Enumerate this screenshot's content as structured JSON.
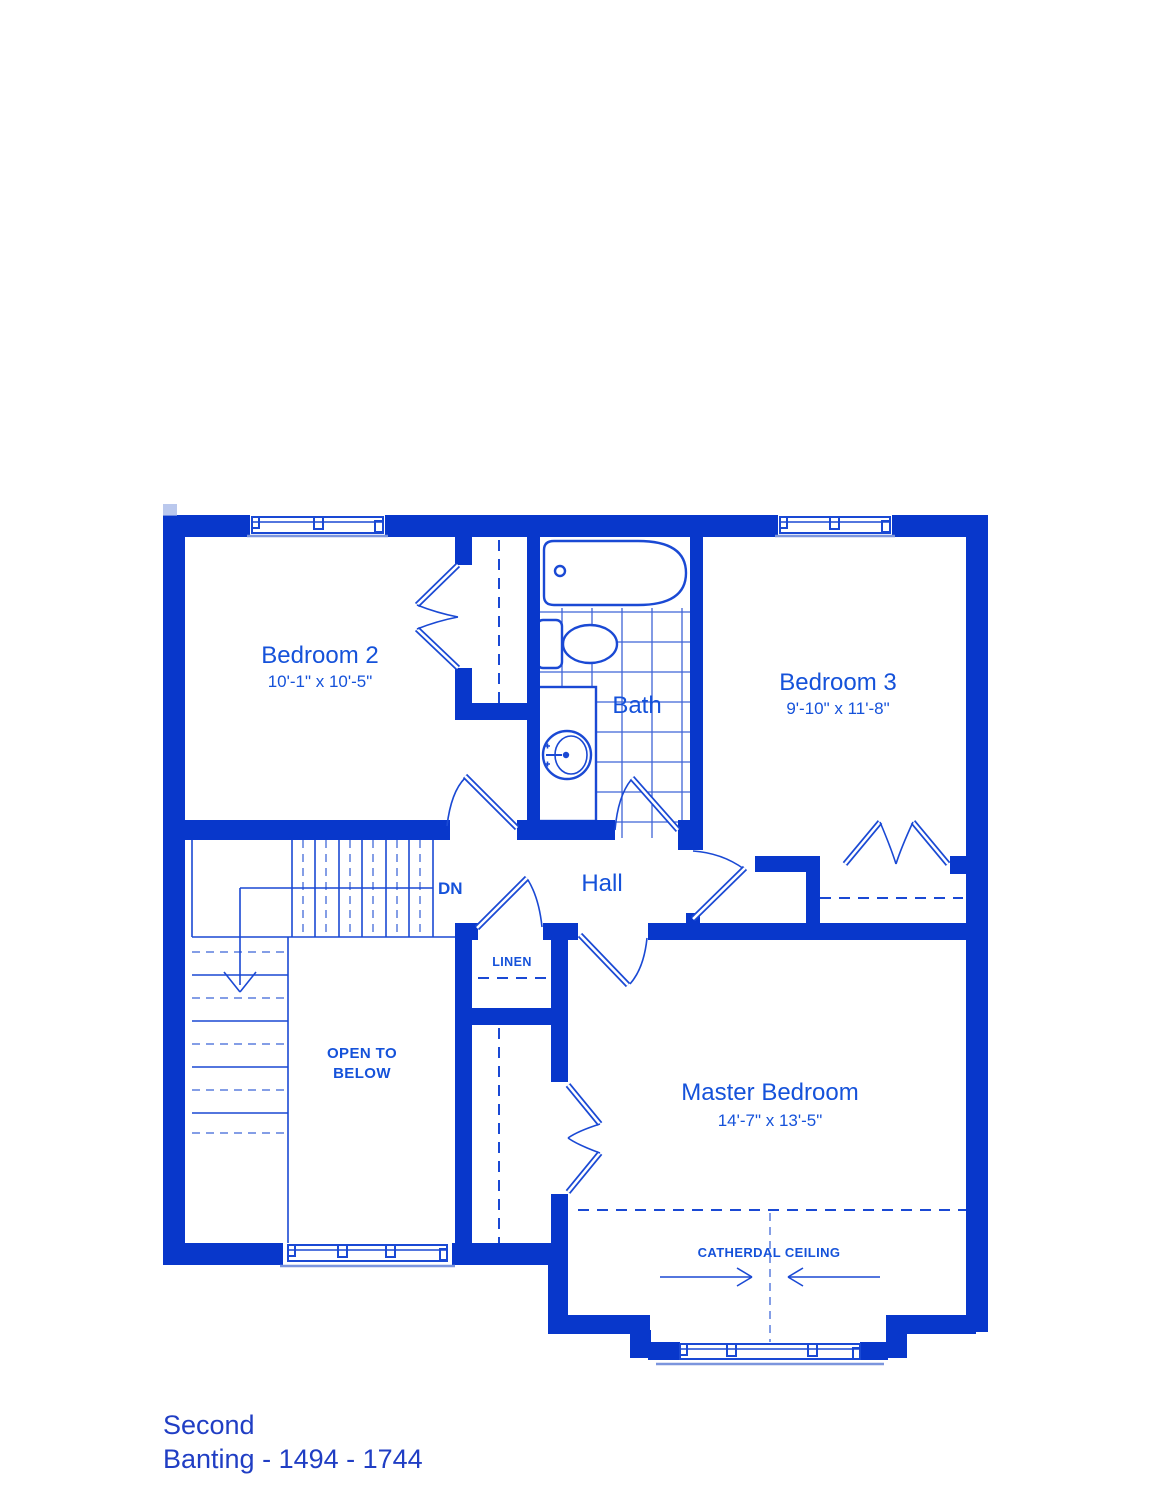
{
  "plan": {
    "rooms": {
      "bedroom2": {
        "name": "Bedroom 2",
        "dims": "10'-1\" x 10'-5\""
      },
      "bedroom3": {
        "name": "Bedroom 3",
        "dims": "9'-10\" x 11'-8\""
      },
      "master": {
        "name": "Master Bedroom",
        "dims": "14'-7\" x 13'-5\""
      },
      "bath": {
        "name": "Bath"
      },
      "hall": {
        "name": "Hall"
      }
    },
    "annotations": {
      "dn": "DN",
      "linen": "LINEN",
      "open_below_l1": "OPEN TO",
      "open_below_l2": "BELOW",
      "cathedral": "CATHERDAL CEILING"
    },
    "footer": {
      "line1": "Second",
      "line2": "Banting - 1494 - 1744"
    },
    "colors": {
      "wall": "#0837cb",
      "line": "#1a49d4",
      "light_line": "#7b95dd",
      "label_text": "#1552da",
      "footer_text": "#203ec4",
      "tile_grid": "#3f63d6",
      "background": "#ffffff"
    }
  }
}
